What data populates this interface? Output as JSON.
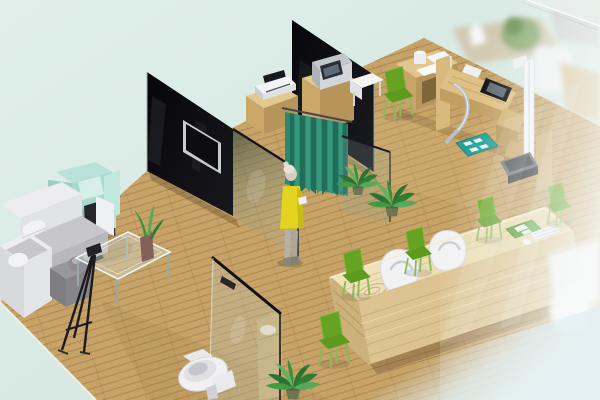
{
  "meta": {
    "description": "Isometric 3D rendering of a clinic interior: lounge sofa area, glass consultation booths with teal curtain and standing person, examination desk with stadiometer, bathroom with toilet, and a wooden reception counter with green waiting chairs behind a frosted glass wall"
  },
  "palette": {
    "background": "#dcebe6",
    "background_deep": "#cfe2dc",
    "floor": "#c7a368",
    "floor_light": "#e0c584",
    "floor_shadow": "#a5834e",
    "wall_dark": "#0a0a0e",
    "glass_edge": "#15151a",
    "curtain": "#2c8870",
    "curtain_dark": "#1f6e59",
    "curtain_light": "#38977c",
    "person_dress": "#e3d51f",
    "person_skin": "#d7cdbd",
    "person_hair": "#e9e3d7",
    "sofa_white": "#ededef",
    "sofa_gray": "#c6c6cb",
    "armchair_mint": "#b9e2d8",
    "armchair_mint_dark": "#8fc3b8",
    "chair_green": "#66a322",
    "chair_green_dark": "#5d9a1e",
    "chair_green_leg": "#8fb858",
    "wood_cabinet_top": "#e3c98f",
    "wood_cabinet": "#c9a86a",
    "wood_cabinet_side": "#b6945a",
    "wood_counter_top": "#ecdfb2",
    "wood_counter_front": "#dcc391",
    "wood_counter_stripe": "#c9ab72",
    "device_white": "#f2f3f5",
    "device_gray": "#c3c6ca",
    "screen_dark": "#121318",
    "screen_glow": "#5e6a76",
    "chrome": "#b9c1c5",
    "mat_teal": "#25a096",
    "plant_green": "#2e7d32",
    "toilet_white": "#f1f1f3",
    "stadiometer_white": "#f3f4f6",
    "platform_dark": "#3c4043",
    "tray_green": "#4c9b2e",
    "haze_blue": "#e2f0f4"
  },
  "objects": {
    "areas": [
      "lounge",
      "consultation-booths",
      "examination-area",
      "bathroom",
      "reception-waiting-area"
    ],
    "items": [
      "wood-plank-floor",
      "dark-glass-partition-wall",
      "wall-mounted-tv",
      "teal-privacy-curtain",
      "standing-person-yellow-dress",
      "potted-plant",
      "white-l-shaped-sofa",
      "mint-armchair",
      "dark-display-board",
      "side-table-with-lamp",
      "glass-coffee-table",
      "aloe-vase",
      "tripod-easel",
      "toilet",
      "bathroom-glass-partition",
      "bathroom-cabinet",
      "consultation-cabinet",
      "printer",
      "tablet-screen",
      "monitor-device",
      "examination-desk",
      "microscope-device",
      "chrome-handle-bar",
      "teal-floor-mat",
      "stadiometer",
      "weighing-platform",
      "reception-counter",
      "white-staff-chair",
      "green-visitor-chair",
      "keyboard",
      "green-document-tray",
      "frosted-glass-wall",
      "blurred-background-equipment"
    ]
  }
}
